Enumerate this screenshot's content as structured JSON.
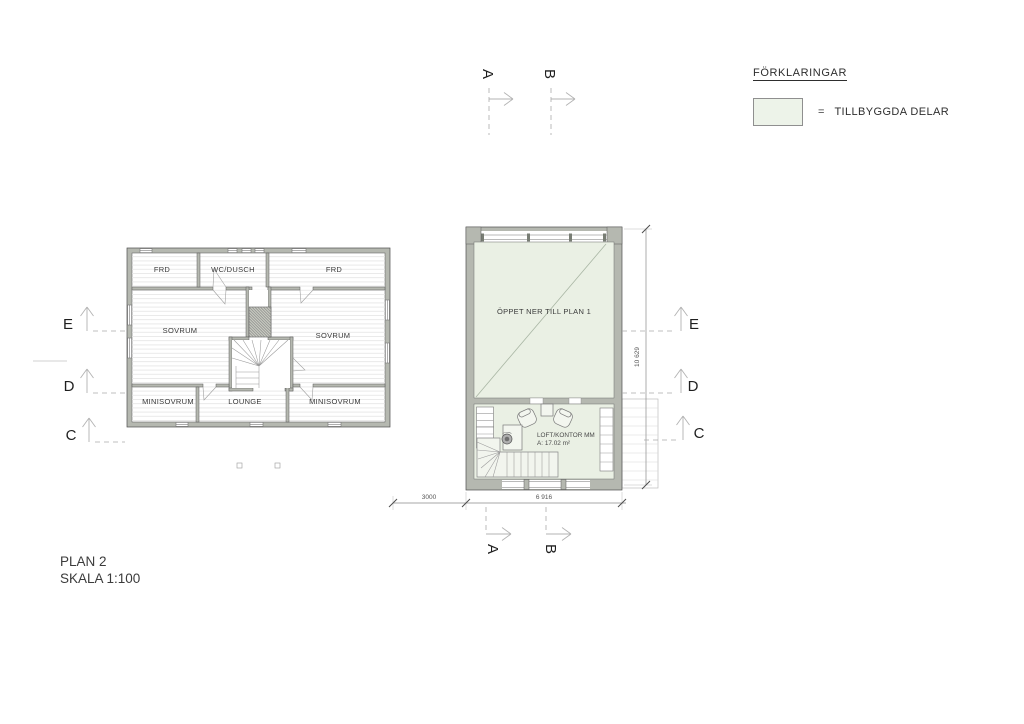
{
  "legend": {
    "title": "FÖRKLARINGAR",
    "equals_sign": "=",
    "item_label": "TILLBYGGDA DELAR",
    "swatch_color": "#edf3e9"
  },
  "title_block": {
    "line1": "PLAN 2",
    "line2": "SKALA 1:100"
  },
  "markers": {
    "top": [
      {
        "label": "A"
      },
      {
        "label": "B"
      }
    ],
    "bottom": [
      {
        "label": "A"
      },
      {
        "label": "B"
      }
    ],
    "left": [
      {
        "label": "E"
      },
      {
        "label": "D"
      },
      {
        "label": "C"
      }
    ],
    "right": [
      {
        "label": "E"
      },
      {
        "label": "D"
      },
      {
        "label": "C"
      }
    ]
  },
  "plan_left": {
    "rooms": [
      {
        "label": "FRD"
      },
      {
        "label": "WC/DUSCH"
      },
      {
        "label": "FRD"
      },
      {
        "label": "SOVRUM"
      },
      {
        "label": "SOVRUM"
      },
      {
        "label": "MINISOVRUM"
      },
      {
        "label": "LOUNGE"
      },
      {
        "label": "MINISOVRUM"
      }
    ]
  },
  "plan_right": {
    "open_area_label": "ÖPPET NER TILL PLAN 1",
    "loft_label": "LOFT/KONTOR MM",
    "loft_area": "A: 17.02 m²"
  },
  "dimensions": {
    "bottom_segment_left": "3000",
    "bottom_segment_right": "6 916",
    "right_vertical": "10 629"
  },
  "colors": {
    "addition_green": "#eaf0e4",
    "wall_gray": "#b5b8b0",
    "outline_dark": "#4f4f4f"
  }
}
